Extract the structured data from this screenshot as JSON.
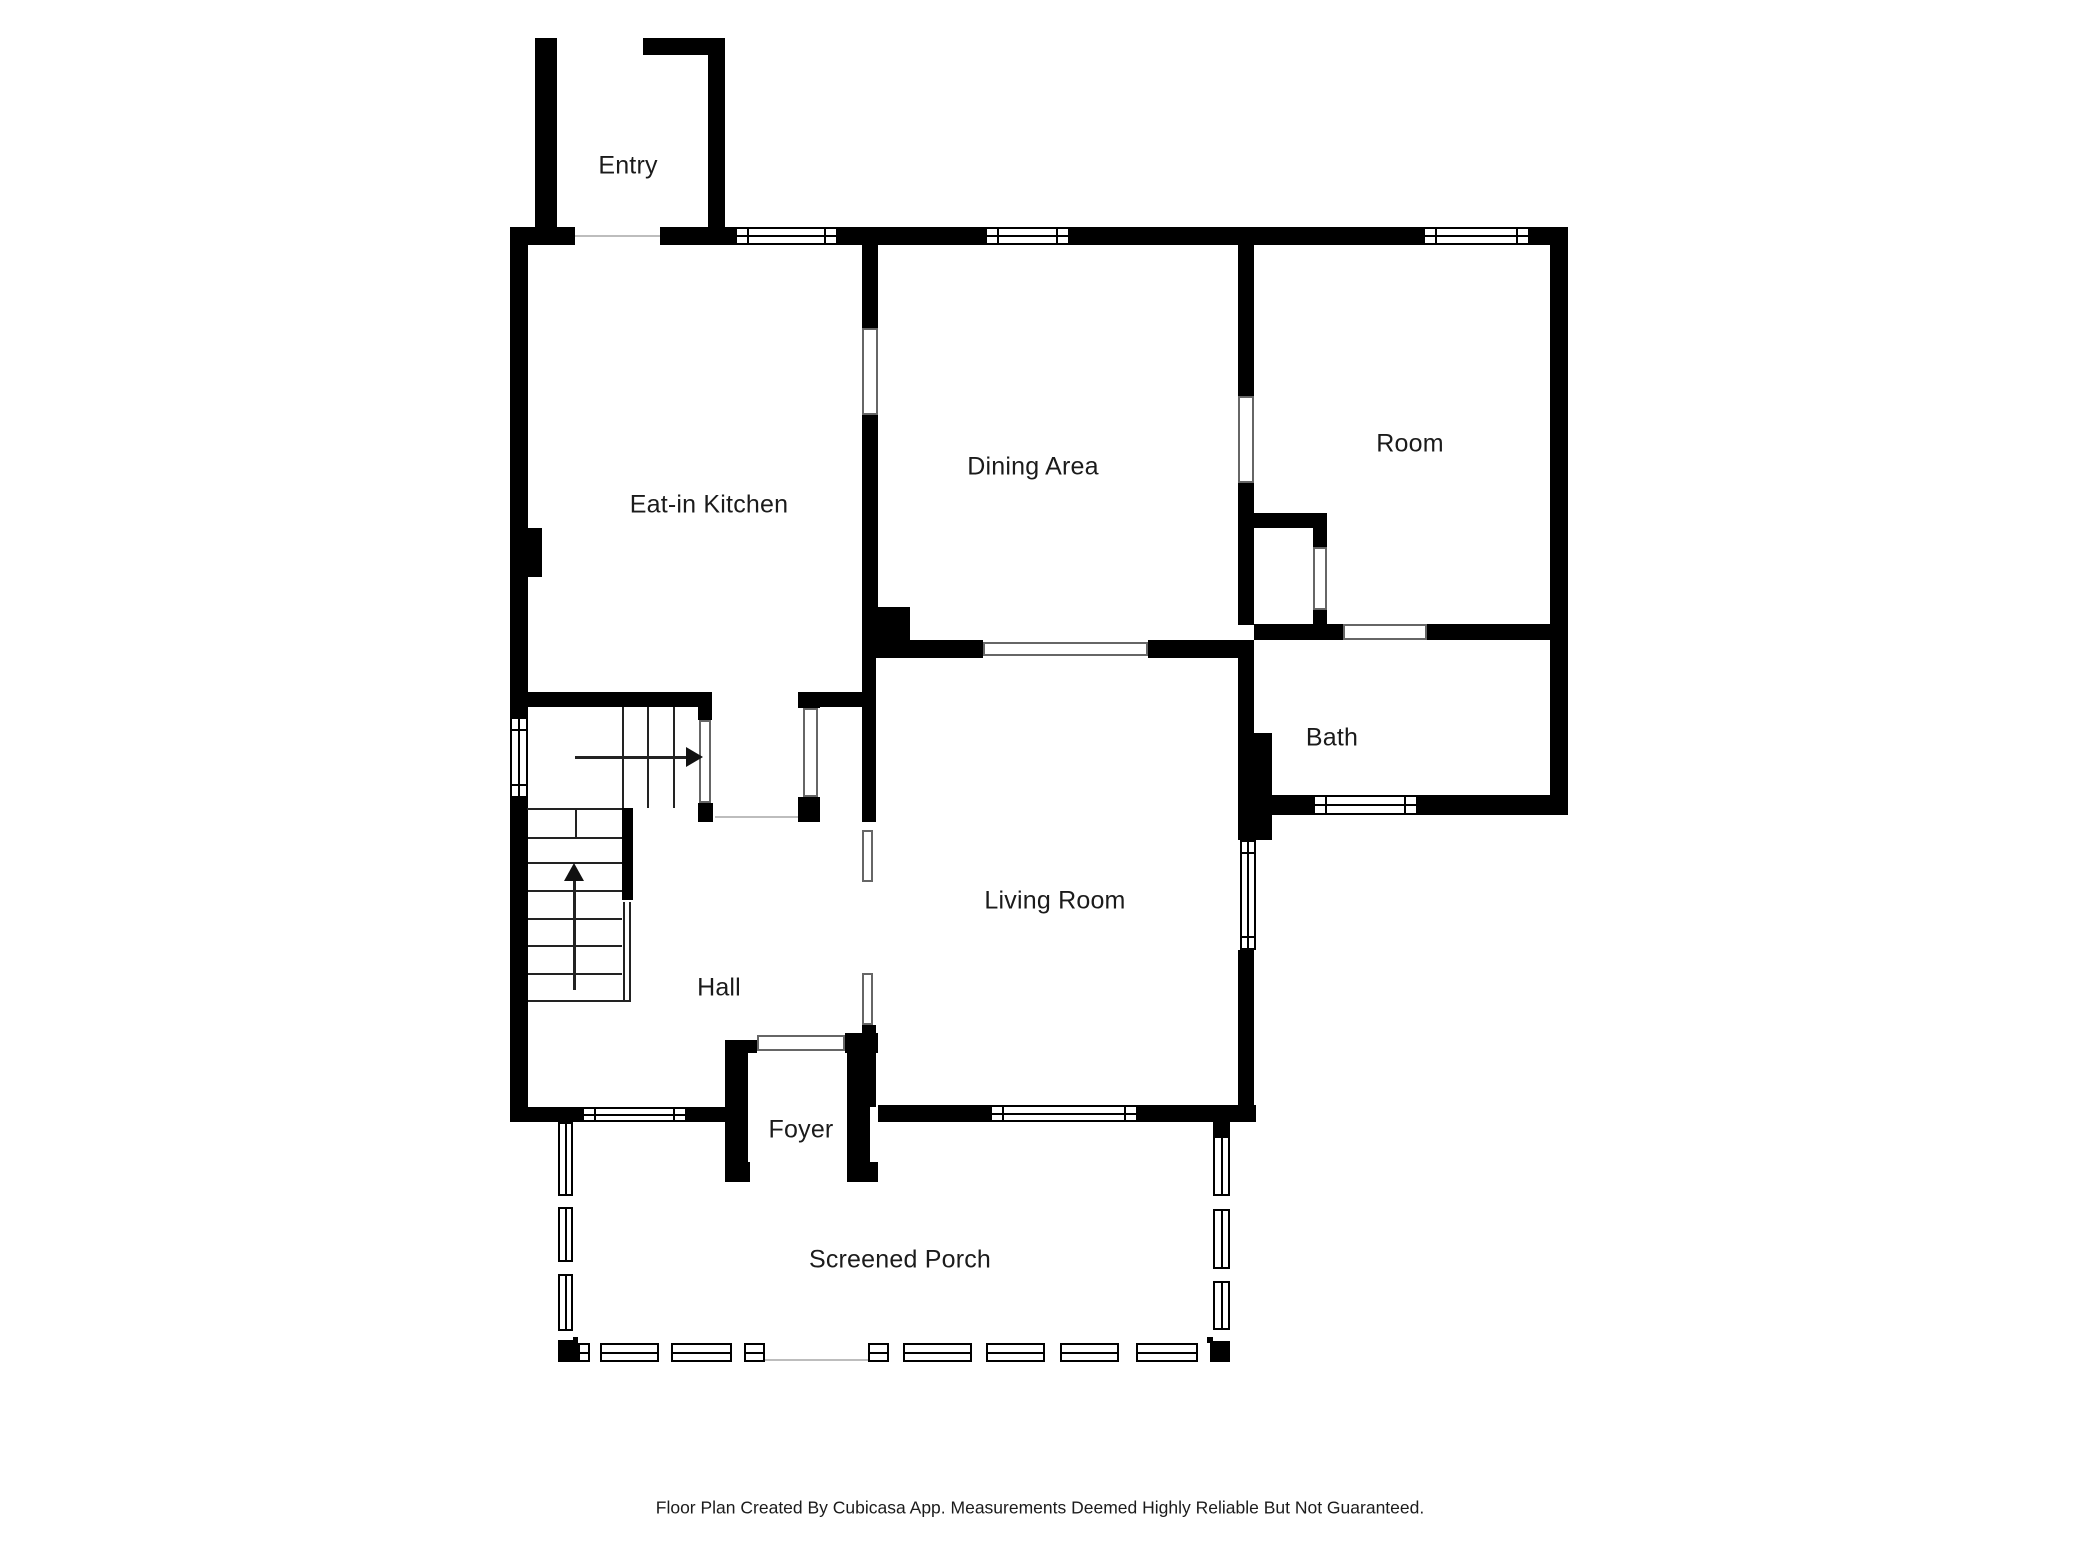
{
  "footer_note": "Floor Plan Created By Cubicasa App. Measurements Deemed Highly Reliable But Not Guaranteed.",
  "colors": {
    "background": "#ffffff",
    "wall": "#000000",
    "label_text": "#1b1b1b",
    "cased_border": "#666666",
    "floor_line": "#bdbdbd",
    "stair_line": "#222222"
  },
  "rooms": [
    {
      "id": "entry",
      "label": "Entry",
      "cx": 628,
      "cy": 166
    },
    {
      "id": "eat-in-kitchen",
      "label": "Eat-in Kitchen",
      "cx": 709,
      "cy": 505
    },
    {
      "id": "dining-area",
      "label": "Dining Area",
      "cx": 1033,
      "cy": 467
    },
    {
      "id": "room",
      "label": "Room",
      "cx": 1410,
      "cy": 444
    },
    {
      "id": "bath",
      "label": "Bath",
      "cx": 1332,
      "cy": 738
    },
    {
      "id": "living-room",
      "label": "Living Room",
      "cx": 1055,
      "cy": 901
    },
    {
      "id": "hall",
      "label": "Hall",
      "cx": 719,
      "cy": 988
    },
    {
      "id": "foyer",
      "label": "Foyer",
      "cx": 801,
      "cy": 1130
    },
    {
      "id": "screened-porch",
      "label": "Screened Porch",
      "cx": 900,
      "cy": 1260
    }
  ],
  "floorplan": {
    "walls": [
      [
        512,
        227,
        63,
        18
      ],
      [
        660,
        227,
        75,
        18
      ],
      [
        838,
        227,
        147,
        18
      ],
      [
        1070,
        227,
        353,
        18
      ],
      [
        1530,
        227,
        38,
        18
      ],
      [
        535,
        38,
        22,
        207
      ],
      [
        643,
        38,
        82,
        17
      ],
      [
        708,
        38,
        17,
        207
      ],
      [
        510,
        227,
        18,
        490
      ],
      [
        510,
        798,
        18,
        324
      ],
      [
        528,
        528,
        14,
        49
      ],
      [
        1550,
        227,
        18,
        588
      ],
      [
        1248,
        795,
        65,
        20
      ],
      [
        1418,
        795,
        150,
        20
      ],
      [
        1238,
        245,
        16,
        151
      ],
      [
        1238,
        483,
        16,
        142
      ],
      [
        1238,
        640,
        16,
        95
      ],
      [
        1238,
        733,
        34,
        107
      ],
      [
        1238,
        950,
        16,
        172
      ],
      [
        1254,
        624,
        89,
        16
      ],
      [
        1427,
        624,
        141,
        16
      ],
      [
        1252,
        513,
        75,
        15
      ],
      [
        1313,
        528,
        14,
        19
      ],
      [
        1313,
        610,
        14,
        14
      ],
      [
        862,
        245,
        16,
        83
      ],
      [
        862,
        415,
        16,
        192
      ],
      [
        862,
        607,
        48,
        51
      ],
      [
        875,
        640,
        108,
        18
      ],
      [
        1148,
        640,
        90,
        18
      ],
      [
        862,
        658,
        14,
        164
      ],
      [
        862,
        1025,
        14,
        82
      ],
      [
        527,
        692,
        185,
        15
      ],
      [
        698,
        705,
        14,
        15
      ],
      [
        698,
        803,
        15,
        19
      ],
      [
        622,
        808,
        11,
        92
      ],
      [
        798,
        692,
        22,
        16
      ],
      [
        820,
        692,
        42,
        15
      ],
      [
        798,
        797,
        22,
        25
      ],
      [
        510,
        1107,
        72,
        15
      ],
      [
        687,
        1107,
        43,
        15
      ],
      [
        878,
        1105,
        112,
        17
      ],
      [
        1138,
        1105,
        118,
        17
      ],
      [
        725,
        1040,
        32,
        13
      ],
      [
        725,
        1053,
        23,
        129
      ],
      [
        725,
        1162,
        25,
        20
      ],
      [
        845,
        1033,
        33,
        20
      ],
      [
        847,
        1053,
        23,
        129
      ],
      [
        852,
        1162,
        26,
        20
      ],
      [
        558,
        1337,
        20,
        25
      ],
      [
        1207,
        1337,
        23,
        25
      ],
      [
        1213,
        1122,
        17,
        14
      ]
    ],
    "windows": [
      {
        "r": [
          735,
          227,
          103,
          18
        ],
        "o": "h"
      },
      {
        "r": [
          985,
          227,
          85,
          18
        ],
        "o": "h"
      },
      {
        "r": [
          1423,
          227,
          107,
          18
        ],
        "o": "h"
      },
      {
        "r": [
          510,
          717,
          18,
          81
        ],
        "o": "v"
      },
      {
        "r": [
          582,
          1107,
          105,
          15
        ],
        "o": "h"
      },
      {
        "r": [
          990,
          1105,
          148,
          17
        ],
        "o": "h"
      },
      {
        "r": [
          1240,
          840,
          16,
          110
        ],
        "o": "v"
      },
      {
        "r": [
          1313,
          795,
          105,
          20
        ],
        "o": "h"
      }
    ],
    "cased": [
      {
        "r": [
          575,
          228,
          85,
          16
        ],
        "t": "line"
      },
      {
        "r": [
          862,
          328,
          16,
          87
        ],
        "t": "box"
      },
      {
        "r": [
          1238,
          396,
          16,
          87
        ],
        "t": "box"
      },
      {
        "r": [
          1313,
          547,
          14,
          63
        ],
        "t": "box"
      },
      {
        "r": [
          1343,
          624,
          84,
          16
        ],
        "t": "box"
      },
      {
        "r": [
          983,
          642,
          165,
          14
        ],
        "t": "box"
      },
      {
        "r": [
          699,
          720,
          12,
          83
        ],
        "t": "box"
      },
      {
        "r": [
          803,
          708,
          15,
          89
        ],
        "t": "box"
      },
      {
        "r": [
          715,
          812,
          83,
          10
        ],
        "t": "line"
      },
      {
        "r": [
          862,
          830,
          11,
          52
        ],
        "t": "box"
      },
      {
        "r": [
          862,
          973,
          11,
          52
        ],
        "t": "box"
      },
      {
        "r": [
          757,
          1035,
          88,
          16
        ],
        "t": "box"
      },
      {
        "r": [
          765,
          1358,
          103,
          4
        ],
        "t": "line"
      }
    ],
    "screens": [
      {
        "r": [
          558,
          1122,
          15,
          216
        ],
        "o": "v",
        "m": [
          [
            1192,
            11
          ],
          [
            1258,
            12
          ],
          [
            1327,
            9
          ]
        ]
      },
      {
        "r": [
          1213,
          1136,
          17,
          201
        ],
        "o": "v",
        "m": [
          [
            1192,
            13
          ],
          [
            1265,
            12
          ],
          [
            1326,
            11
          ]
        ]
      },
      {
        "r": [
          578,
          1343,
          187,
          19
        ],
        "o": "h",
        "m": [
          [
            586,
            10
          ],
          [
            655,
            12
          ],
          [
            728,
            12
          ]
        ]
      },
      {
        "r": [
          868,
          1343,
          339,
          19
        ],
        "o": "h",
        "m": [
          [
            885,
            14
          ],
          [
            968,
            14
          ],
          [
            1041,
            15
          ],
          [
            1115,
            17
          ],
          [
            1194,
            12
          ]
        ]
      }
    ],
    "stairs": {
      "vlines": [
        [
          622,
          707,
          101
        ],
        [
          647,
          707,
          101
        ],
        [
          673,
          707,
          101
        ],
        [
          575,
          808,
          29
        ]
      ],
      "hlines": [
        [
          527,
          808,
          95
        ],
        [
          528,
          837,
          94
        ],
        [
          528,
          862,
          94
        ],
        [
          528,
          890,
          94
        ],
        [
          528,
          918,
          94
        ],
        [
          528,
          945,
          94
        ],
        [
          528,
          973,
          94
        ],
        [
          528,
          1000,
          103
        ]
      ],
      "rail": [
        623,
        902,
        8,
        98
      ]
    },
    "arrows": [
      {
        "line": [
          575,
          756,
          112,
          3
        ],
        "head": "right",
        "hx": 686,
        "hy": 747
      },
      {
        "line": [
          573,
          880,
          3,
          110
        ],
        "head": "up",
        "hx": 564,
        "hy": 863
      }
    ]
  }
}
